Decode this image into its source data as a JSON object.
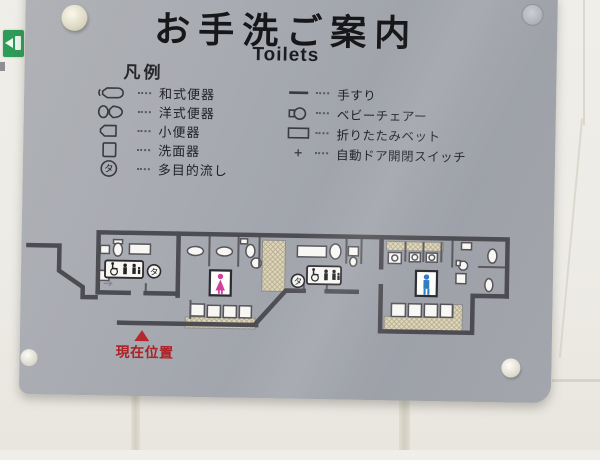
{
  "sign": {
    "title": "お手洗ご案内",
    "subtitle": "Toilets",
    "legend_heading": "凡例",
    "legend_left": [
      {
        "icon": "squat-toilet-icon",
        "label": "和式便器"
      },
      {
        "icon": "western-toilet-icon",
        "label": "洋式便器"
      },
      {
        "icon": "urinal-icon",
        "label": "小便器"
      },
      {
        "icon": "washbasin-icon",
        "label": "洗面器"
      },
      {
        "icon": "multipurpose-sink-icon",
        "label": "多目的流し"
      }
    ],
    "legend_right": [
      {
        "icon": "handrail-icon",
        "label": "手すり"
      },
      {
        "icon": "baby-chair-icon",
        "label": "ベビーチェアー"
      },
      {
        "icon": "folding-bed-icon",
        "label": "折りたたみベット"
      },
      {
        "icon": "auto-door-switch-icon",
        "label": "自動ドア開閉スイッチ"
      }
    ],
    "map": {
      "current_location_label": "現在位置",
      "multipurpose_symbol": "タ"
    },
    "colors": {
      "plate_gray": "#a3a6ad",
      "wall_line": "#4c4c52",
      "hatch_beige": "#ddd6bf",
      "current_location_red": "#b5282e",
      "women_pink": "#d23f9c",
      "men_blue": "#2d7dc2",
      "exit_sign_green": "#2f9b58"
    }
  }
}
